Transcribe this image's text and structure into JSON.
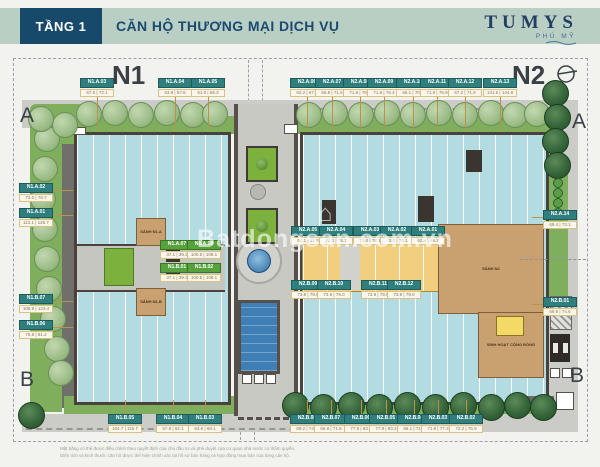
{
  "header": {
    "floor_label": "TẦNG 1",
    "title": "CĂN HỘ THƯƠNG MẠI DỊCH VỤ",
    "brand": "TUMYS",
    "brand_sub": "PHÚ MỸ"
  },
  "watermark": {
    "text": "Batdongsan.com.vn",
    "icon": "⌂"
  },
  "plan": {
    "block_labels": {
      "n1": "N1",
      "n2": "N2"
    },
    "grid_markers": {
      "top_left": "A",
      "top_right": "A",
      "bottom_left": "B",
      "bottom_right": "B"
    },
    "lobbies": {
      "n1a": "SẢNH N1.A",
      "n1b": "SẢNH N1.B",
      "n2": "SẢNH N2",
      "community": "SINH HOẠT CỘNG ĐỒNG"
    },
    "colors": {
      "header_bg": "#b9cfc4",
      "badge_bg": "#17496b",
      "navy": "#1b4a70",
      "chip_teal": "#2e7f7d",
      "chip_green": "#56a23c",
      "unit_blue": "#b2dce2",
      "shop_yellow": "#f2cf7f",
      "lobby_tan": "#c9a171",
      "grass": "#7fae5c",
      "pool": "#3f7fb5"
    },
    "units": [
      {
        "id": "N1.A.03",
        "areas": "67.5 | 72.1",
        "x": 97,
        "y": 78,
        "c": "teal",
        "l": "d"
      },
      {
        "id": "N1.A.04",
        "areas": "53.8 | 57.6",
        "x": 175,
        "y": 78,
        "c": "teal",
        "l": "d"
      },
      {
        "id": "N1.A.05",
        "areas": "61.0 | 65.3",
        "x": 208,
        "y": 78,
        "c": "teal",
        "l": "d"
      },
      {
        "id": "N2.A.06",
        "areas": "63.2 | 67.8",
        "x": 307,
        "y": 78,
        "c": "teal",
        "l": "d"
      },
      {
        "id": "N2.A.07",
        "areas": "66.8 | 71.5",
        "x": 332,
        "y": 78,
        "c": "teal",
        "l": "d"
      },
      {
        "id": "N2.A.08",
        "areas": "71.9 | 76.4",
        "x": 360,
        "y": 78,
        "c": "teal",
        "l": "d"
      },
      {
        "id": "N2.A.09",
        "areas": "71.9 | 76.4",
        "x": 384,
        "y": 78,
        "c": "teal",
        "l": "d"
      },
      {
        "id": "N2.A.10",
        "areas": "66.1 | 70.7",
        "x": 413,
        "y": 78,
        "c": "teal",
        "l": "d"
      },
      {
        "id": "N2.A.11",
        "areas": "71.9 | 76.9",
        "x": 437,
        "y": 78,
        "c": "teal",
        "l": "d"
      },
      {
        "id": "N2.A.12",
        "areas": "67.2 | 71.9",
        "x": 465,
        "y": 78,
        "c": "teal",
        "l": "d"
      },
      {
        "id": "N2.A.13",
        "areas": "131.6 | 144.8",
        "x": 500,
        "y": 78,
        "c": "teal",
        "l": "d"
      },
      {
        "id": "N1.A.02",
        "areas": "73.0 | 78.7",
        "x": 36,
        "y": 183,
        "c": "teal",
        "l": "r"
      },
      {
        "id": "N1.A.01",
        "areas": "112.1 | 126.7",
        "x": 36,
        "y": 208,
        "c": "teal",
        "l": "r"
      },
      {
        "id": "N1.B.07",
        "areas": "108.9 | 123.4",
        "x": 36,
        "y": 294,
        "c": "teal",
        "l": "r"
      },
      {
        "id": "N1.B.06",
        "areas": "75.8 | 81.2",
        "x": 36,
        "y": 320,
        "c": "teal",
        "l": "r"
      },
      {
        "id": "N1.B.05",
        "areas": "104.7 | 115.7",
        "x": 125,
        "y": 414,
        "c": "teal",
        "l": "u"
      },
      {
        "id": "N1.B.04",
        "areas": "57.8 | 62.1",
        "x": 173,
        "y": 414,
        "c": "teal",
        "l": "u"
      },
      {
        "id": "N1.B.03",
        "areas": "63.6 | 68.1",
        "x": 205,
        "y": 414,
        "c": "teal",
        "l": "u"
      },
      {
        "id": "N2.B.08",
        "areas": "69.2 | 74.1",
        "x": 307,
        "y": 414,
        "c": "teal",
        "l": "u"
      },
      {
        "id": "N2.B.07",
        "areas": "66.8 | 71.8",
        "x": 331,
        "y": 414,
        "c": "teal",
        "l": "u"
      },
      {
        "id": "N2.B.06",
        "areas": "77.9 | 83.2",
        "x": 361,
        "y": 414,
        "c": "teal",
        "l": "u"
      },
      {
        "id": "N2.B.05",
        "areas": "77.9 | 83.2",
        "x": 386,
        "y": 414,
        "c": "teal",
        "l": "u"
      },
      {
        "id": "N2.B.04",
        "areas": "66.1 | 71.1",
        "x": 414,
        "y": 414,
        "c": "teal",
        "l": "u"
      },
      {
        "id": "N2.B.03",
        "areas": "71.9 | 77.3",
        "x": 438,
        "y": 414,
        "c": "teal",
        "l": "u"
      },
      {
        "id": "N2.B.02",
        "areas": "72.2 | 76.9",
        "x": 466,
        "y": 414,
        "c": "teal",
        "l": "u"
      },
      {
        "id": "N2.A.14",
        "areas": "69.4 | 73.1",
        "x": 560,
        "y": 210,
        "c": "teal",
        "l": "l"
      },
      {
        "id": "N2.B.01",
        "areas": "69.9 | 74.6",
        "x": 560,
        "y": 297,
        "c": "teal",
        "l": "l"
      },
      {
        "id": "N1.A.07",
        "areas": "37.1 | 39.3",
        "x": 177,
        "y": 240,
        "c": "green"
      },
      {
        "id": "N1.A.08",
        "areas": "100.5 | 108.1",
        "x": 204,
        "y": 240,
        "c": "green"
      },
      {
        "id": "N1.B.01",
        "areas": "37.1 | 39.3",
        "x": 177,
        "y": 263,
        "c": "green"
      },
      {
        "id": "N1.B.02",
        "areas": "100.5 | 108.1",
        "x": 204,
        "y": 263,
        "c": "green"
      },
      {
        "id": "N2.A.05",
        "areas": "52.1 | 55.8",
        "x": 308,
        "y": 226,
        "c": "teal"
      },
      {
        "id": "N2.A.04",
        "areas": "73.0 | 78.1",
        "x": 336,
        "y": 226,
        "c": "teal"
      },
      {
        "id": "N2.A.03",
        "areas": "73.0 | 78.1",
        "x": 370,
        "y": 226,
        "c": "teal"
      },
      {
        "id": "N2.A.02",
        "areas": "73.0 | 78.1",
        "x": 397,
        "y": 226,
        "c": "teal"
      },
      {
        "id": "N2.A.01",
        "areas": "92.4 | 99.2",
        "x": 428,
        "y": 226,
        "c": "teal"
      },
      {
        "id": "N2.B.09",
        "areas": "73.9 | 79.0",
        "x": 308,
        "y": 280,
        "c": "teal"
      },
      {
        "id": "N2.B.10",
        "areas": "73.9 | 79.0",
        "x": 334,
        "y": 280,
        "c": "teal"
      },
      {
        "id": "N2.B.11",
        "areas": "73.9 | 79.0",
        "x": 378,
        "y": 280,
        "c": "teal"
      },
      {
        "id": "N2.B.12",
        "areas": "73.9 | 79.0",
        "x": 404,
        "y": 280,
        "c": "teal"
      }
    ]
  },
  "footer": {
    "note_line1": "Mặt bằng có thể được điều chỉnh theo quyết định của chủ đầu tư và phê duyệt của cơ quan nhà nước có thẩm quyền.",
    "note_line2": "Diện tích và kích thước căn hộ được thể hiện chính xác tại hồ sơ bán hàng và hợp đồng mua bán của từng căn hộ."
  }
}
